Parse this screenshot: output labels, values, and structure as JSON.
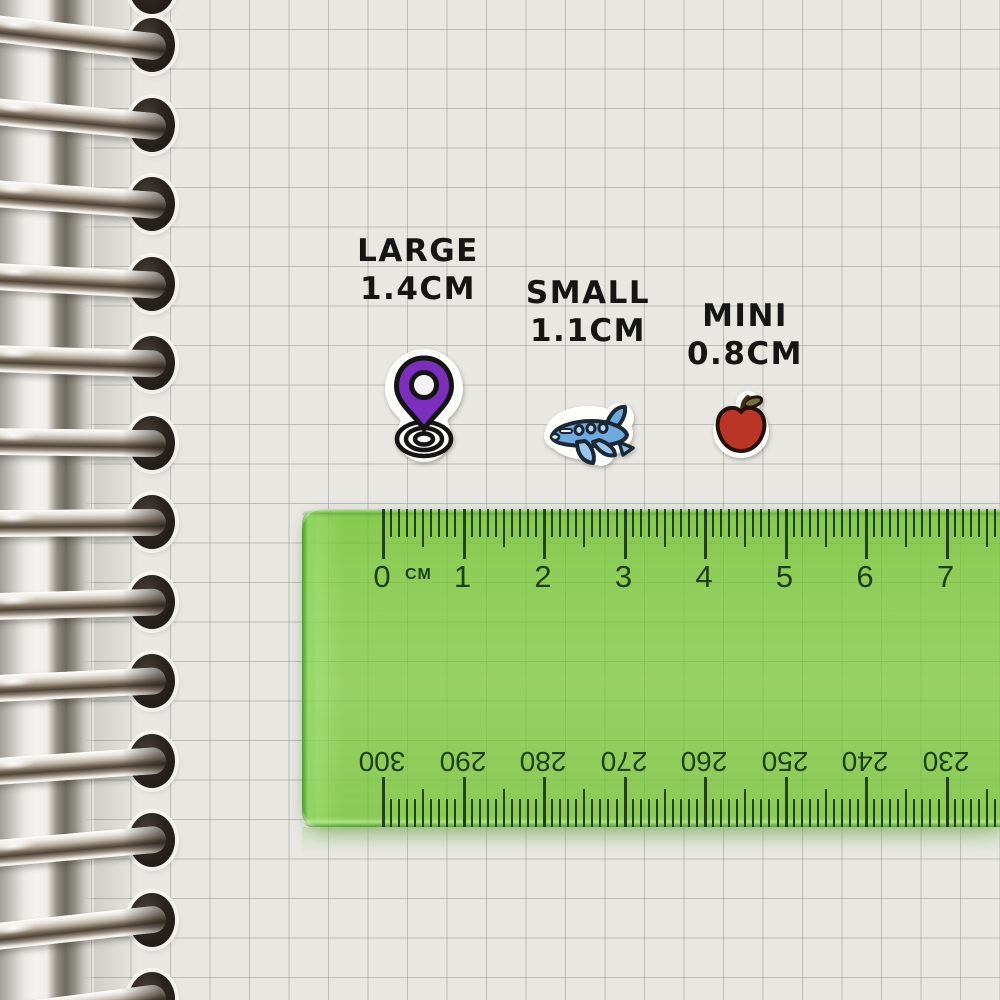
{
  "notebook": {
    "paper_color": "#e8e7e2",
    "grid_line_color": "#b9b8b3",
    "binding": {
      "ring_count": 13,
      "ring_highlight_color": "#f7f5f1",
      "ring_shadow_color": "#5a4f44",
      "hole_color": "#241f19"
    }
  },
  "stickers": [
    {
      "label": "LARGE",
      "size_text": "1.4CM",
      "icon": "location-pin-sticker",
      "accent_color": "#7c2ebd"
    },
    {
      "label": "SMALL",
      "size_text": "1.1CM",
      "icon": "airplane-sticker",
      "accent_color": "#6fa9dd"
    },
    {
      "label": "MINI",
      "size_text": "0.8CM",
      "icon": "apple-sticker",
      "accent_color": "#bb3527"
    }
  ],
  "label_text_color": "#151515",
  "ruler": {
    "body_color": "#8ccb55",
    "tick_color": "#1c3a12",
    "unit_label": "CM",
    "top_scale_numbers": [
      "0",
      "1",
      "2",
      "3",
      "4",
      "5",
      "6",
      "7"
    ],
    "bottom_scale_numbers": [
      "300",
      "290",
      "280",
      "270",
      "260",
      "250",
      "240",
      "230"
    ]
  }
}
